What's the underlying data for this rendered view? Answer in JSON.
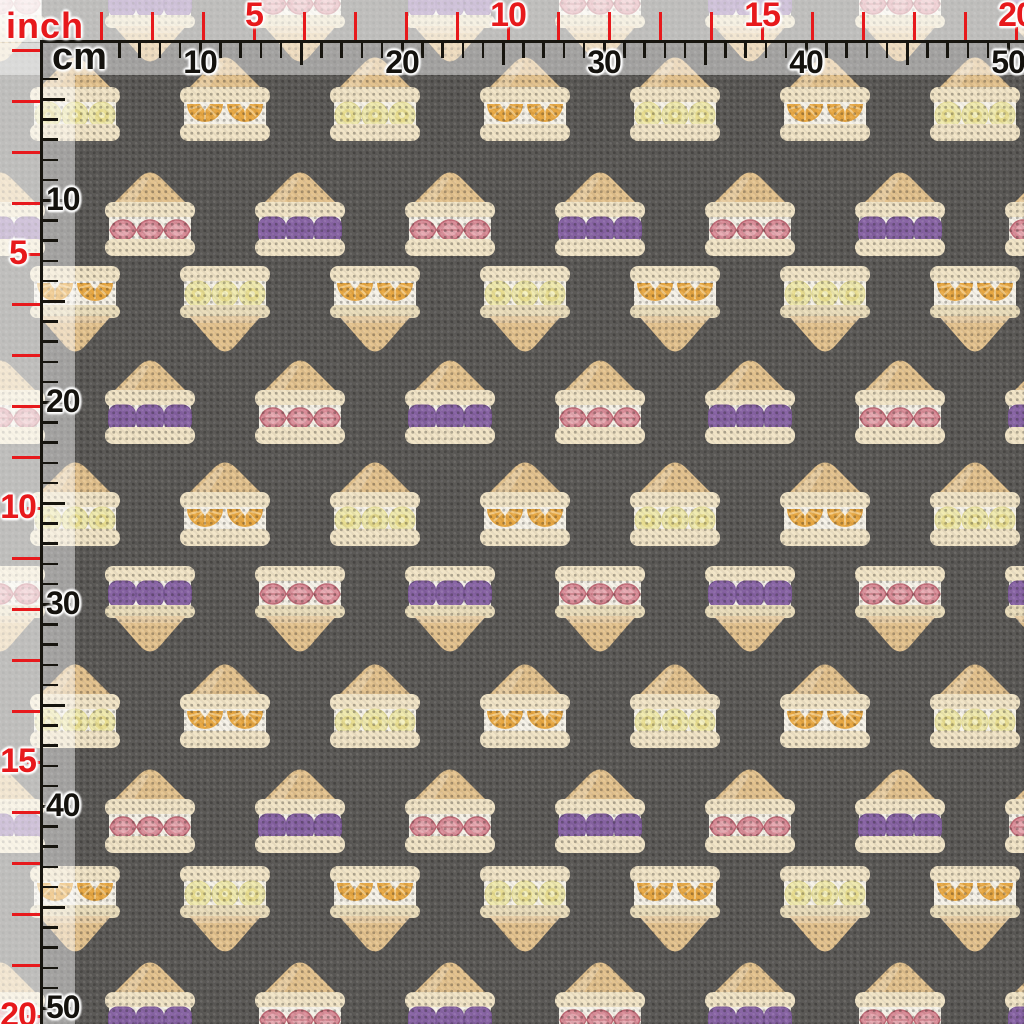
{
  "app": {
    "description": "Fabric swatch preview of fruit sandwich pattern with inch and cm rulers"
  },
  "rulers": {
    "inch_label": "inch",
    "cm_label": "cm",
    "inch_color": "#e7191c",
    "cm_color": "#17150f",
    "px_per_inch": 50.8,
    "px_per_cm": 20.2,
    "cm_origin_offset": -2,
    "inch_marks": [
      {
        "label": "5",
        "value": 5
      },
      {
        "label": "10",
        "value": 10
      },
      {
        "label": "15",
        "value": 15
      },
      {
        "label": "20",
        "value": 20
      }
    ],
    "cm_marks": [
      {
        "label": "10",
        "value": 10
      },
      {
        "label": "20",
        "value": 20
      },
      {
        "label": "30",
        "value": 30
      },
      {
        "label": "40",
        "value": 40
      },
      {
        "label": "50",
        "value": 50
      }
    ]
  },
  "fabric": {
    "background_color": "#5c5a57",
    "pattern_name": "fruit-sandwiches",
    "cell": {
      "width": 150,
      "sandwich_width": 92,
      "up_height": 87,
      "down_height": 92
    },
    "colors": {
      "crust": "#e3c28e",
      "bread": "#f1e4c6",
      "bread_mid": "#eaddbb",
      "cream": "#f6f2e8",
      "strawberry": "#d98d98",
      "strawberry_dark": "#c06a76",
      "strawberry_light": "#e8aeb5",
      "grape": "#8a66a6",
      "grape_dark": "#7b5898",
      "grape_line": "#9b79b5",
      "orange": "#e7a742",
      "orange_light": "#f4cd8a",
      "banana": "#efe9ae",
      "banana_mark": "#e6d987",
      "banana_edge": "#e4dc96"
    },
    "rows": [
      {
        "y": -25,
        "dir": "down",
        "offset": 0,
        "fruits": [
          "strawberry",
          "grape"
        ]
      },
      {
        "y": 55,
        "dir": "up",
        "offset": 75,
        "fruits": [
          "banana",
          "orange"
        ]
      },
      {
        "y": 170,
        "dir": "up",
        "offset": 0,
        "fruits": [
          "grape",
          "strawberry"
        ]
      },
      {
        "y": 265,
        "dir": "down",
        "offset": 75,
        "fruits": [
          "orange",
          "banana"
        ]
      },
      {
        "y": 358,
        "dir": "up",
        "offset": 0,
        "fruits": [
          "strawberry",
          "grape"
        ]
      },
      {
        "y": 460,
        "dir": "up",
        "offset": 75,
        "fruits": [
          "banana",
          "orange"
        ]
      },
      {
        "y": 565,
        "dir": "down",
        "offset": 0,
        "fruits": [
          "strawberry",
          "grape"
        ]
      },
      {
        "y": 662,
        "dir": "up",
        "offset": 75,
        "fruits": [
          "banana",
          "orange"
        ]
      },
      {
        "y": 767,
        "dir": "up",
        "offset": 0,
        "fruits": [
          "grape",
          "strawberry"
        ]
      },
      {
        "y": 865,
        "dir": "down",
        "offset": 75,
        "fruits": [
          "orange",
          "banana"
        ]
      },
      {
        "y": 960,
        "dir": "up",
        "offset": 0,
        "fruits": [
          "strawberry",
          "grape"
        ]
      }
    ]
  },
  "overlay": {
    "outer_opacity": 0.62,
    "inner_opacity": 0.45
  }
}
